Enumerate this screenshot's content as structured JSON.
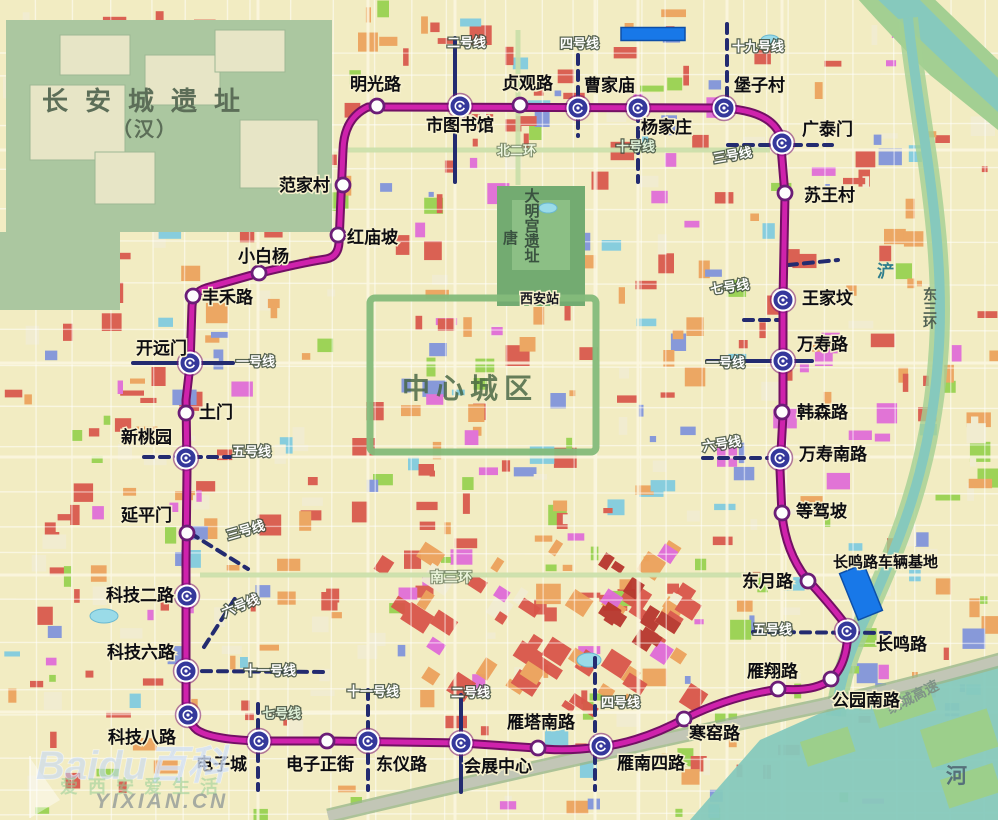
{
  "map_title": "西安地铁环线规划图",
  "loop_line": {
    "color_core": "#cf22ac",
    "color_casing": "#721064",
    "path": "M 368,107 L 720,108 Q 770,110 780,135 L 785,195 L 783,300 L 783,415 L 780,470 L 782,515 Q 786,552 806,578 Q 828,602 842,620 Q 850,630 846,650 Q 842,670 830,680 Q 814,692 780,689 Q 730,696 686,718 Q 642,742 600,747 Q 562,752 536,748 L 462,743 L 330,741 L 262,741 Q 212,740 197,730 Q 187,722 186,702 L 186,560 L 187,470 L 186,400 L 190,365 L 192,306 Q 193,292 206,288 L 252,275 Q 300,263 326,259 Q 338,257 339,243 L 343,150 Q 344,118 368,107 Z"
  },
  "stations": [
    {
      "name": "明光路",
      "x": 377,
      "y": 106,
      "type": "regular",
      "lx": 350,
      "ly": 90
    },
    {
      "name": "市图书馆",
      "x": 460,
      "y": 106,
      "type": "interchange",
      "lx": 426,
      "ly": 131
    },
    {
      "name": "贞观路",
      "x": 520,
      "y": 105,
      "type": "regular",
      "lx": 502,
      "ly": 89
    },
    {
      "name": "曹家庙",
      "x": 578,
      "y": 108,
      "type": "interchange",
      "lx": 584,
      "ly": 91
    },
    {
      "name": "杨家庄",
      "x": 638,
      "y": 108,
      "type": "interchange",
      "lx": 641,
      "ly": 133
    },
    {
      "name": "堡子村",
      "x": 724,
      "y": 108,
      "type": "interchange",
      "lx": 734,
      "ly": 91
    },
    {
      "name": "广泰门",
      "x": 782,
      "y": 143,
      "type": "interchange",
      "lx": 802,
      "ly": 135
    },
    {
      "name": "苏王村",
      "x": 785,
      "y": 193,
      "type": "regular",
      "lx": 804,
      "ly": 201
    },
    {
      "name": "王家坟",
      "x": 783,
      "y": 300,
      "type": "interchange",
      "lx": 802,
      "ly": 304
    },
    {
      "name": "万寿路",
      "x": 783,
      "y": 361,
      "type": "interchange",
      "lx": 797,
      "ly": 350
    },
    {
      "name": "韩森路",
      "x": 782,
      "y": 412,
      "type": "regular",
      "lx": 797,
      "ly": 418
    },
    {
      "name": "万寿南路",
      "x": 780,
      "y": 458,
      "type": "interchange",
      "lx": 799,
      "ly": 460
    },
    {
      "name": "等驾坡",
      "x": 782,
      "y": 513,
      "type": "regular",
      "lx": 796,
      "ly": 517
    },
    {
      "name": "东月路",
      "x": 808,
      "y": 581,
      "type": "regular",
      "lx": 742,
      "ly": 587
    },
    {
      "name": "长鸣路",
      "x": 847,
      "y": 631,
      "type": "interchange",
      "lx": 876,
      "ly": 650
    },
    {
      "name": "公园南路",
      "x": 831,
      "y": 679,
      "type": "regular",
      "lx": 832,
      "ly": 706
    },
    {
      "name": "雁翔路",
      "x": 778,
      "y": 689,
      "type": "regular",
      "lx": 747,
      "ly": 677
    },
    {
      "name": "寒窑路",
      "x": 684,
      "y": 719,
      "type": "regular",
      "lx": 689,
      "ly": 739
    },
    {
      "name": "雁南四路",
      "x": 601,
      "y": 746,
      "type": "interchange",
      "lx": 617,
      "ly": 769
    },
    {
      "name": "雁塔南路",
      "x": 538,
      "y": 748,
      "type": "regular",
      "lx": 507,
      "ly": 728
    },
    {
      "name": "会展中心",
      "x": 461,
      "y": 743,
      "type": "interchange",
      "lx": 464,
      "ly": 772
    },
    {
      "name": "东仪路",
      "x": 368,
      "y": 741,
      "type": "interchange",
      "lx": 376,
      "ly": 770
    },
    {
      "name": "电子正街",
      "x": 327,
      "y": 741,
      "type": "regular",
      "lx": 286,
      "ly": 770
    },
    {
      "name": "电子城",
      "x": 259,
      "y": 741,
      "type": "interchange",
      "lx": 196,
      "ly": 770
    },
    {
      "name": "科技八路",
      "x": 188,
      "y": 715,
      "type": "interchange",
      "lx": 108,
      "ly": 743
    },
    {
      "name": "科技六路",
      "x": 186,
      "y": 671,
      "type": "interchange",
      "lx": 107,
      "ly": 658
    },
    {
      "name": "科技二路",
      "x": 187,
      "y": 596,
      "type": "interchange",
      "lx": 106,
      "ly": 601
    },
    {
      "name": "延平门",
      "x": 187,
      "y": 533,
      "type": "regular",
      "lx": 121,
      "ly": 521
    },
    {
      "name": "新桃园",
      "x": 186,
      "y": 458,
      "type": "interchange",
      "lx": 121,
      "ly": 443
    },
    {
      "name": "土门",
      "x": 186,
      "y": 413,
      "type": "regular",
      "lx": 199,
      "ly": 418
    },
    {
      "name": "开远门",
      "x": 190,
      "y": 363,
      "type": "interchange",
      "lx": 136,
      "ly": 354
    },
    {
      "name": "丰禾路",
      "x": 193,
      "y": 296,
      "type": "regular",
      "lx": 202,
      "ly": 303
    },
    {
      "name": "小白杨",
      "x": 259,
      "y": 273,
      "type": "regular",
      "lx": 238,
      "ly": 262
    },
    {
      "name": "红庙坡",
      "x": 338,
      "y": 235,
      "type": "regular",
      "lx": 347,
      "ly": 243
    },
    {
      "name": "范家村",
      "x": 343,
      "y": 185,
      "type": "regular",
      "lx": 279,
      "ly": 191
    }
  ],
  "metro_segments": [
    {
      "style": "solid",
      "x1": 455,
      "y1": 38,
      "x2": 455,
      "y2": 182
    },
    {
      "style": "solid",
      "x1": 461,
      "y1": 695,
      "x2": 461,
      "y2": 792
    },
    {
      "style": "solid",
      "x1": 133,
      "y1": 363,
      "x2": 233,
      "y2": 363
    },
    {
      "style": "solid",
      "x1": 707,
      "y1": 361,
      "x2": 812,
      "y2": 361
    },
    {
      "style": "dashed",
      "x1": 578,
      "y1": 55,
      "x2": 578,
      "y2": 136
    },
    {
      "style": "dashed",
      "x1": 595,
      "y1": 658,
      "x2": 595,
      "y2": 790
    },
    {
      "style": "dashed",
      "x1": 638,
      "y1": 112,
      "x2": 638,
      "y2": 182
    },
    {
      "style": "dashed",
      "x1": 727,
      "y1": 24,
      "x2": 727,
      "y2": 100
    },
    {
      "style": "dashed",
      "x1": 728,
      "y1": 145,
      "x2": 832,
      "y2": 145
    },
    {
      "style": "dashed",
      "x1": 788,
      "y1": 265,
      "x2": 838,
      "y2": 260
    },
    {
      "style": "dashed",
      "x1": 190,
      "y1": 533,
      "x2": 248,
      "y2": 569
    },
    {
      "style": "dashed",
      "x1": 744,
      "y1": 320,
      "x2": 783,
      "y2": 320
    },
    {
      "style": "dashed",
      "x1": 258,
      "y1": 704,
      "x2": 258,
      "y2": 790
    },
    {
      "style": "dashed",
      "x1": 703,
      "y1": 458,
      "x2": 772,
      "y2": 458
    },
    {
      "style": "dashed",
      "x1": 204,
      "y1": 647,
      "x2": 236,
      "y2": 597
    },
    {
      "style": "dashed",
      "x1": 753,
      "y1": 632,
      "x2": 893,
      "y2": 633
    },
    {
      "style": "dashed",
      "x1": 144,
      "y1": 457,
      "x2": 230,
      "y2": 457
    },
    {
      "style": "dashed",
      "x1": 186,
      "y1": 671,
      "x2": 324,
      "y2": 672
    },
    {
      "style": "dashed",
      "x1": 368,
      "y1": 690,
      "x2": 368,
      "y2": 790
    }
  ],
  "line_labels": [
    {
      "text": "二号线",
      "x": 447,
      "y": 47,
      "rot": 0
    },
    {
      "text": "四号线",
      "x": 560,
      "y": 48,
      "rot": 0
    },
    {
      "text": "十九号线",
      "x": 732,
      "y": 51,
      "rot": 0
    },
    {
      "text": "十号线",
      "x": 616,
      "y": 151,
      "rot": 0,
      "tone": "light"
    },
    {
      "text": "三号线",
      "x": 714,
      "y": 163,
      "rot": -10
    },
    {
      "text": "七号线",
      "x": 711,
      "y": 294,
      "rot": -8
    },
    {
      "text": "一号线",
      "x": 706,
      "y": 367,
      "rot": 0
    },
    {
      "text": "六号线",
      "x": 703,
      "y": 451,
      "rot": -8
    },
    {
      "text": "五号线",
      "x": 753,
      "y": 634,
      "rot": 0
    },
    {
      "text": "四号线",
      "x": 601,
      "y": 707,
      "rot": 0
    },
    {
      "text": "二号线",
      "x": 451,
      "y": 697,
      "rot": 0
    },
    {
      "text": "十一号线",
      "x": 347,
      "y": 696,
      "rot": 0
    },
    {
      "text": "七号线",
      "x": 262,
      "y": 718,
      "rot": 0,
      "tone": "light"
    },
    {
      "text": "十一号线",
      "x": 244,
      "y": 675,
      "rot": 0
    },
    {
      "text": "六号线",
      "x": 224,
      "y": 617,
      "rot": -22
    },
    {
      "text": "三号线",
      "x": 228,
      "y": 540,
      "rot": -16
    },
    {
      "text": "五号线",
      "x": 232,
      "y": 456,
      "rot": 0
    },
    {
      "text": "一号线",
      "x": 236,
      "y": 366,
      "rot": 0
    }
  ],
  "area_labels": [
    {
      "text": "长安城遗址",
      "x": 42,
      "y": 110,
      "size": 26,
      "color": "#5c6e58",
      "spacing": 17,
      "bold": true
    },
    {
      "text": "（汉）",
      "x": 112,
      "y": 136,
      "size": 20,
      "color": "#5c6e58",
      "spacing": 2,
      "bold": true
    },
    {
      "text": "大明宫遗址",
      "x": 531,
      "y": 188,
      "size": 15,
      "color": "#3a5240",
      "vertical": true,
      "bold": true
    },
    {
      "text": "唐",
      "x": 503,
      "y": 243,
      "size": 15,
      "color": "#3a5240",
      "bold": true
    },
    {
      "text": "西安站",
      "x": 520,
      "y": 303,
      "size": 13,
      "color": "#15151f",
      "halo": true,
      "bold": true
    },
    {
      "text": "中心城区",
      "x": 402,
      "y": 398,
      "size": 28,
      "color": "rgba(70,100,66,0.82)",
      "spacing": 6,
      "bold": true
    },
    {
      "text": "北二环",
      "x": 497,
      "y": 155,
      "size": 13,
      "color": "#eef7e0",
      "shadow": true,
      "bold": true
    },
    {
      "text": "南三环",
      "x": 430,
      "y": 582,
      "size": 14,
      "color": "#eaf4da",
      "shadow": true,
      "bold": true
    },
    {
      "text": "东三环",
      "x": 930,
      "y": 287,
      "size": 14,
      "color": "#4f5f52",
      "vertical": true,
      "bold": true
    },
    {
      "text": "浐",
      "x": 877,
      "y": 277,
      "size": 17,
      "color": "#2e7d8c",
      "bold": true
    },
    {
      "text": "河",
      "x": 946,
      "y": 783,
      "size": 21,
      "color": "#56707a",
      "bold": true
    },
    {
      "text": "绕城高速",
      "x": 890,
      "y": 714,
      "size": 14,
      "color": "#7f9387",
      "rot": -27,
      "bold": true
    },
    {
      "text": "长鸣路车辆基地",
      "x": 833,
      "y": 567,
      "size": 15,
      "color": "#0d0d12",
      "halo": true,
      "bold": true
    }
  ],
  "depots": [
    {
      "cx": 653,
      "cy": 34,
      "w": 64,
      "h": 13,
      "rot": 0
    },
    {
      "cx": 861,
      "cy": 592,
      "w": 26,
      "h": 50,
      "rot": -22
    }
  ],
  "ponds": [
    {
      "cx": 104,
      "cy": 616,
      "rx": 14,
      "ry": 7
    },
    {
      "cx": 589,
      "cy": 660,
      "rx": 12,
      "ry": 7
    },
    {
      "cx": 770,
      "cy": 40,
      "rx": 9,
      "ry": 5
    },
    {
      "cx": 548,
      "cy": 208,
      "rx": 9,
      "ry": 5
    }
  ],
  "watermark": {
    "brand": "Baidu百科",
    "slogan": "爱西安爱生活",
    "site": "YIXIAN.CN"
  },
  "colors": {
    "base": "#f2ecc2",
    "metro_other": "#232b70",
    "water": "#86c9bd",
    "bank": "#a3cf92",
    "heritage_green": "#abc7a0",
    "park_green": "#73ab71",
    "wall_green": "#84ba7a",
    "depot_blue": "#1878e8",
    "highway": "#c2c6b6"
  }
}
